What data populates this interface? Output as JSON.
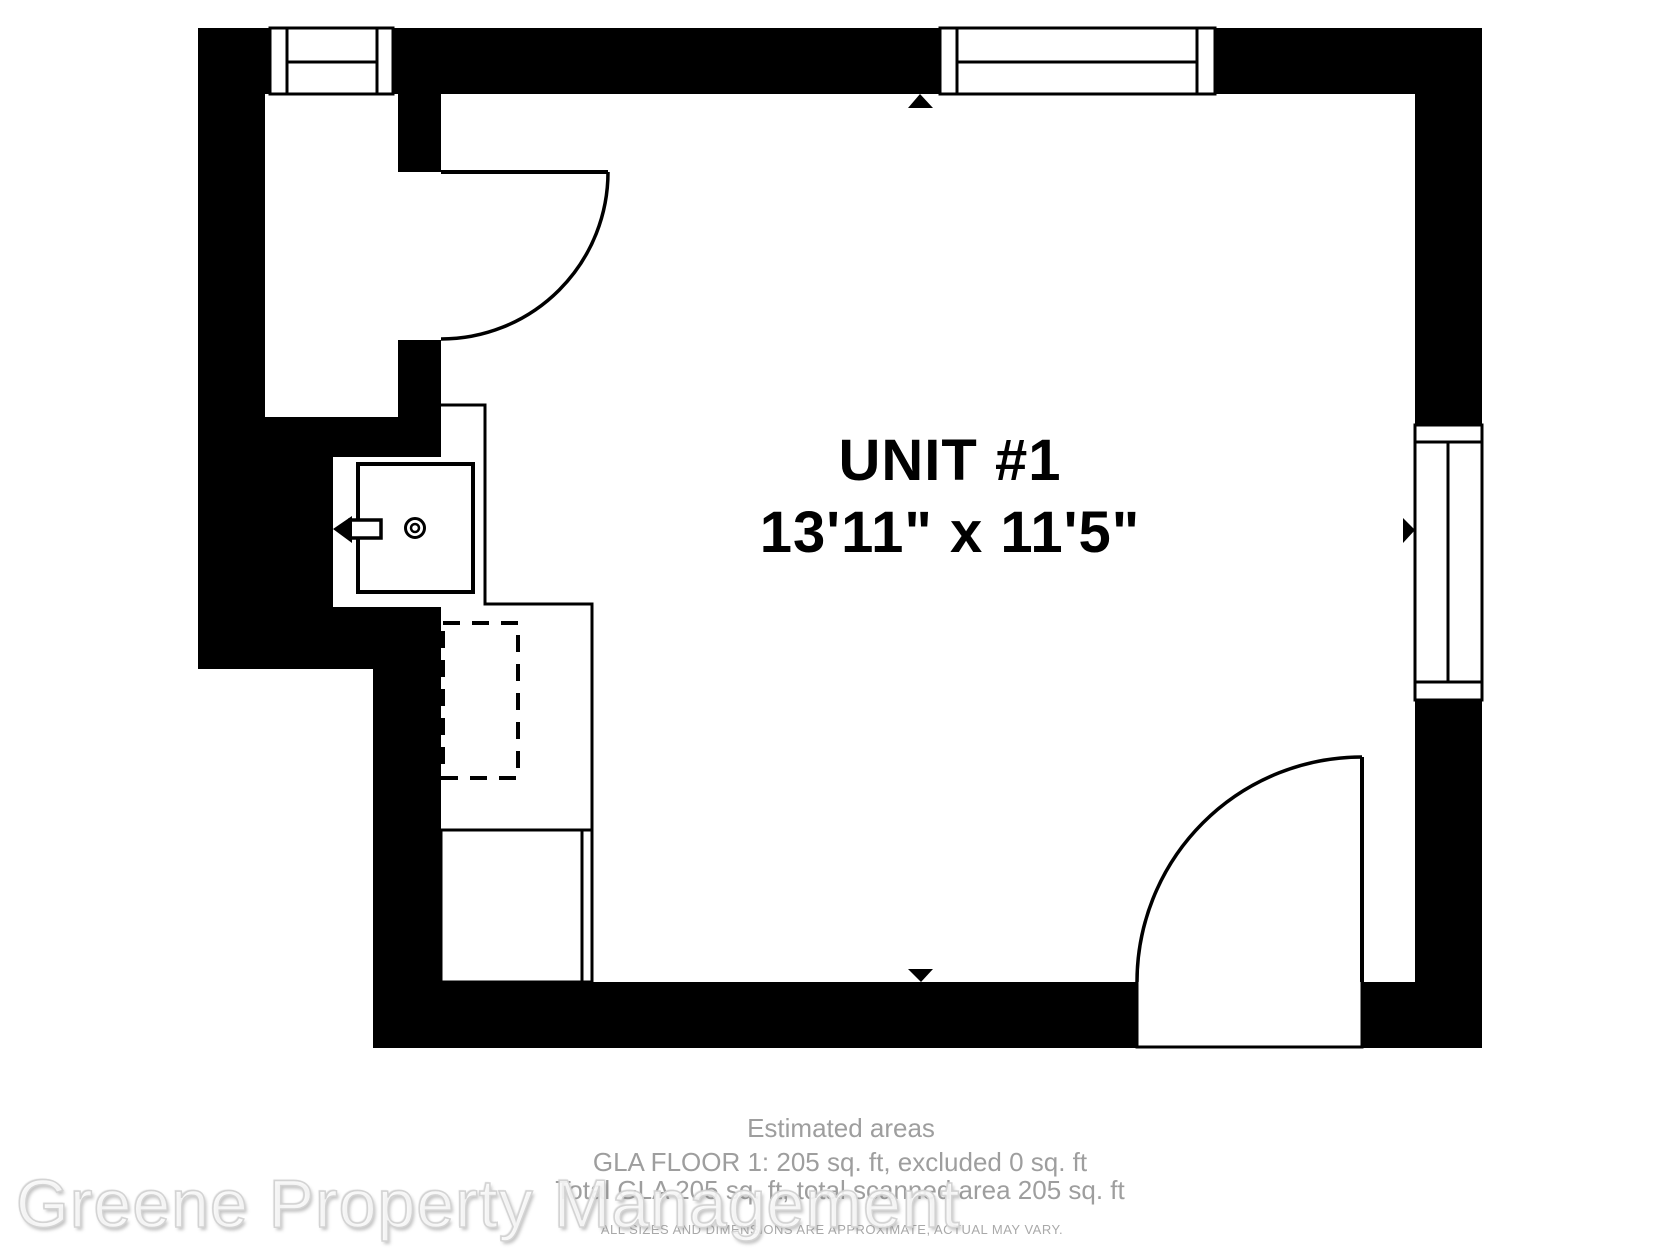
{
  "plan": {
    "room": {
      "label": "UNIT #1",
      "dimensions": "13'11\" x 11'5\""
    },
    "colors": {
      "wall": "#000000",
      "floor": "#ffffff",
      "fixture_stroke": "#000000"
    },
    "fixtures": {
      "windows": [
        "window-top-left",
        "window-top-right",
        "window-right"
      ],
      "doors": [
        "door-top-left",
        "door-bottom-right"
      ],
      "kitchen": [
        "sink",
        "counter",
        "base-cabinet",
        "hidden-appliance"
      ],
      "dimension_arrows": [
        "up",
        "down",
        "left",
        "right"
      ]
    }
  },
  "footer": {
    "title": "Estimated areas",
    "line1": "GLA FLOOR 1: 205 sq. ft, excluded 0 sq. ft",
    "line2": "Total GLA 205 sq. ft, total scanned area 205 sq. ft",
    "disclaimer": "ALL SIZES AND DIMENSIONS ARE APPROXIMATE, ACTUAL MAY VARY.",
    "watermark": "Greene Property Management"
  }
}
